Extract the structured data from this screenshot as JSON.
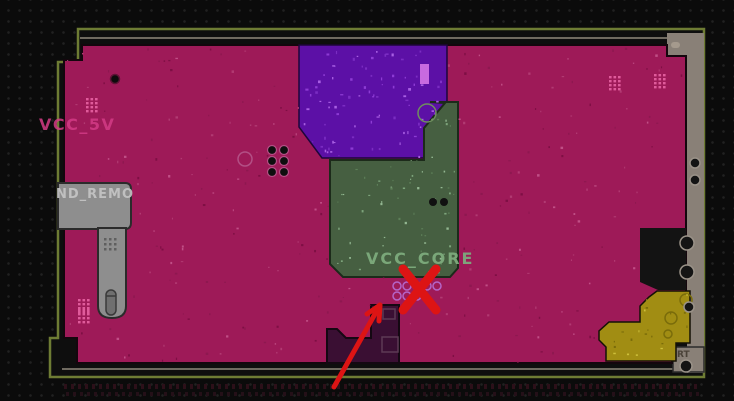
{
  "board": {
    "net_labels": {
      "vcc_5v": "VCC_5V",
      "gnd_remote": "ND_REMO",
      "vcc_core": "VCC_CORE"
    },
    "corner_marking": "RT",
    "icons": {
      "cross": "red-x-rejection-mark",
      "arrow": "red-pointer-arrow"
    },
    "colors": {
      "bg": "#0b0b0b",
      "boardDark": "#0e0e0e",
      "plane": "#9e1a58",
      "purple": "#5c10a6",
      "green": "#465f41",
      "yellow": "#a18d13",
      "grayRegion": "#8e8e8e",
      "taupe": "#898077",
      "olive": "#6e7c34",
      "grayLine": "#6f6a60",
      "red": "#dd1414",
      "labelPink": "#d43c86",
      "labelGreen": "#7dab7d",
      "labelGray": "#c6c6c6",
      "darkPoly": "#3a0f33",
      "voidDark": "#131313"
    }
  }
}
